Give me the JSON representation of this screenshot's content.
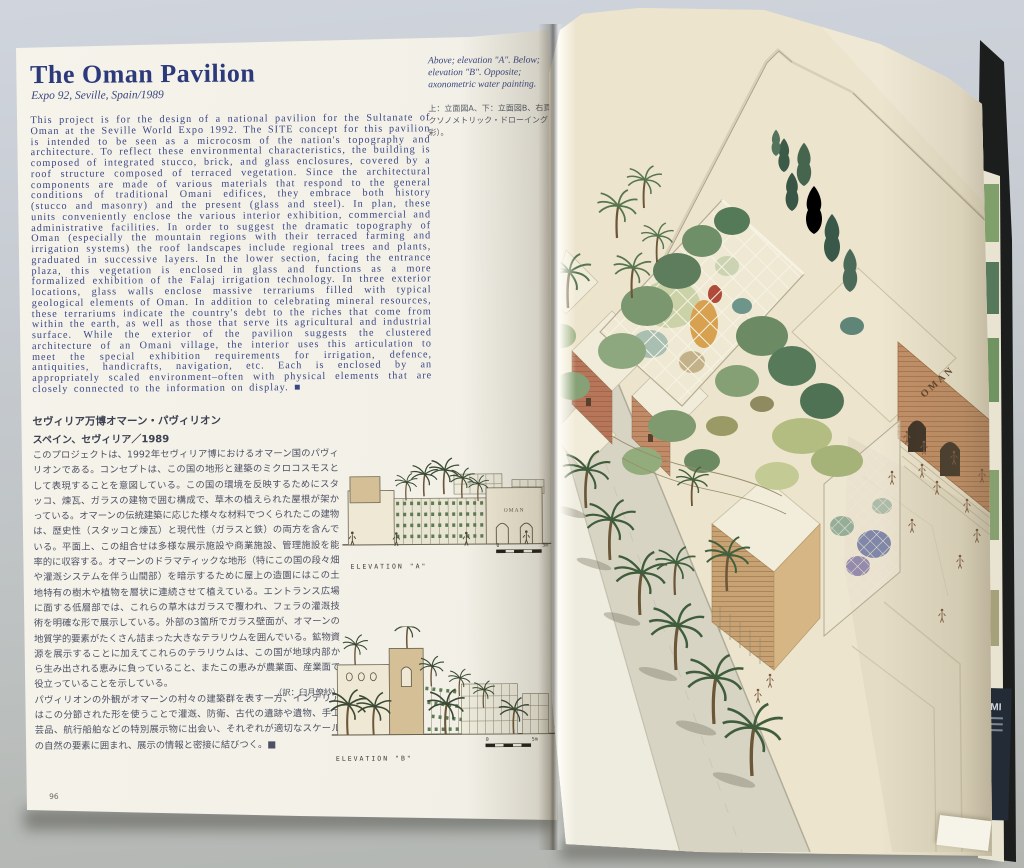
{
  "left_page": {
    "page_number": "96",
    "title": "The Oman Pavilion",
    "subtitle": "Expo 92, Seville, Spain/1989",
    "body": "This project is for the design of a national pavilion for the Sultanate of Oman at the Seville World Expo 1992. The SITE concept for this pavilion is intended to be seen as a microcosm of the nation's topography and architecture. To reflect these environmental characteristics, the building is composed of integrated stucco, brick, and glass enclosures, covered by a roof structure composed of terraced vegetation. Since the architectural components are made of various materials that respond to the general conditions of traditional Omani edifices, they embrace both history (stucco and masonry) and the present (glass and steel). In plan, these units conveniently enclose the various interior exhibition, commercial and administrative facilities. In order to suggest the dramatic topography of Oman (especially the mountain regions with their terraced farming and irrigation systems) the roof landscapes include regional trees and plants, graduated in successive layers. In the lower section, facing the entrance plaza, this vegetation is enclosed in glass and functions as a more formalized exhibition of the Falaj irrigation technology. In three exterior locations, glass walls enclose massive terrariums filled with typical geological elements of Oman. In addition to celebrating mineral resources, these terrariums indicate the country's debt to the riches that come from within the earth, as well as those that serve its agricultural and industrial surface. While the exterior of the pavilion suggests the clustered architecture of an Omani village, the interior uses this articulation to meet the special exhibition requirements for irrigation, defence, antiquities, handicrafts, navigation, etc. Each is enclosed by an appropriately scaled environment–often with physical elements that are closely connected to the information on display. ■",
    "caption_en": "Above; elevation \"A\". Below; elevation \"B\". Opposite; axonometric water painting.",
    "caption_jp": "上：立面図A、下：立面図B、右頁：アクソノメトリック・ドローイング（水彩）。",
    "jp_title": "セヴィリア万博オマーン・パヴィリオン",
    "jp_subtitle": "スペイン、セヴィリア／1989",
    "jp_para1": "このプロジェクトは、1992年セヴィリア博におけるオマーン国のパヴィリオンである。コンセプトは、この国の地形と建築のミクロコスモスとして表現することを意図している。この国の環境を反映するためにスタッコ、煉瓦、ガラスの建物で囲む構成で、草木の植えられた屋根が架かっている。オマーンの伝統建築に応じた様々な材料でつくられたこの建物は、歴史性（スタッコと煉瓦）と現代性（ガラスと鉄）の両方を含んでいる。平面上、この組合せは多様な展示施設や商業施設、管理施設を能率的に収容する。オマーンのドラマティックな地形（特にこの国の段々畑や灌漑システムを伴う山間部）を暗示するために屋上の造園にはこの土地特有の樹木や植物を層状に連続させて植えている。エントランス広場に面する低層部では、これらの草木はガラスで覆われ、フェラの灌漑技術を明確な形で展示している。外部の3箇所でガラス壁面が、オマーンの地質学的要素がたくさん詰まった大きなテラリウムを囲んでいる。鉱物資源を展示することに加えてこれらのテラリウムは、この国が地球内部から生み出される恵みに負っていること、またこの恵みが農業面、産業面で役立っていることを示している。",
    "jp_para2": "パヴィリオンの外観がオマーンの村々の建築群を表す一方、インテリアはこの分節された形を使うことで灌漑、防衛、古代の遺跡や遺物、手工芸品、航行船舶などの特別展示物に出会い、それぞれが適切なスケールの自然の要素に囲まれ、展示の情報と密接に結びつく。■",
    "jp_credit": "（訳：臼月僚紗）",
    "elevation_a": {
      "label": "ELEVATION \"A\"",
      "sign": "OMAN",
      "scale_start": "0",
      "scale_end": "5m"
    },
    "elevation_b": {
      "label": "ELEVATION \"B\"",
      "scale_start": "0",
      "scale_end": "5m"
    }
  },
  "right_page": {
    "painting_sign": "OMAN"
  },
  "book_edge": {
    "spine_text": "ZUMI"
  },
  "colors": {
    "ink_navy": "#3b4784",
    "title_navy": "#2c3a7c",
    "jp_text": "#4d5163",
    "page_cream": "#f1efe5",
    "painting_paper": "#ece4cd",
    "vegetation_green": "#6c8a64",
    "brick": "#b7765a",
    "cover_black": "#1b1e1c"
  }
}
